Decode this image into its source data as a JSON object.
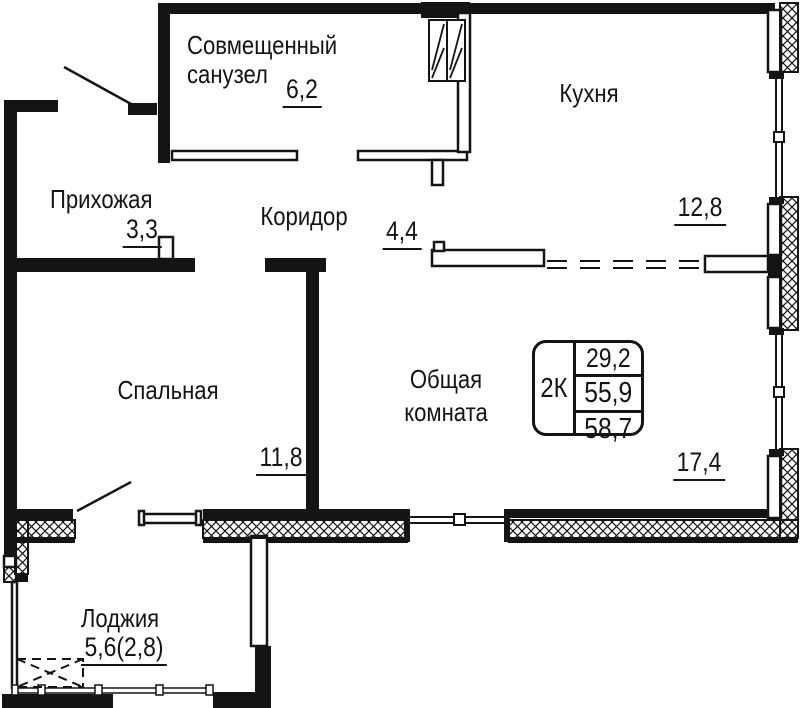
{
  "plan": {
    "rooms": {
      "bathroom": {
        "name": "Совмещенный санузел",
        "area": "6,2"
      },
      "kitchen": {
        "name": "Кухня",
        "area": "12,8"
      },
      "hallway": {
        "name": "Прихожая",
        "area": "3,3"
      },
      "corridor": {
        "name": "Коридор",
        "area": "4,4"
      },
      "bedroom": {
        "name": "Спальная",
        "area": "11,8"
      },
      "living_room": {
        "name": "Общая комната",
        "area": "17,4"
      },
      "loggia": {
        "name": "Лоджия",
        "area": "5,6(2,8)"
      }
    },
    "info_box": {
      "type": "2К",
      "value1": "29,2",
      "value2": "55,9",
      "value3": "58,7"
    },
    "colors": {
      "line": "#141414",
      "background": "#ffffff"
    }
  }
}
